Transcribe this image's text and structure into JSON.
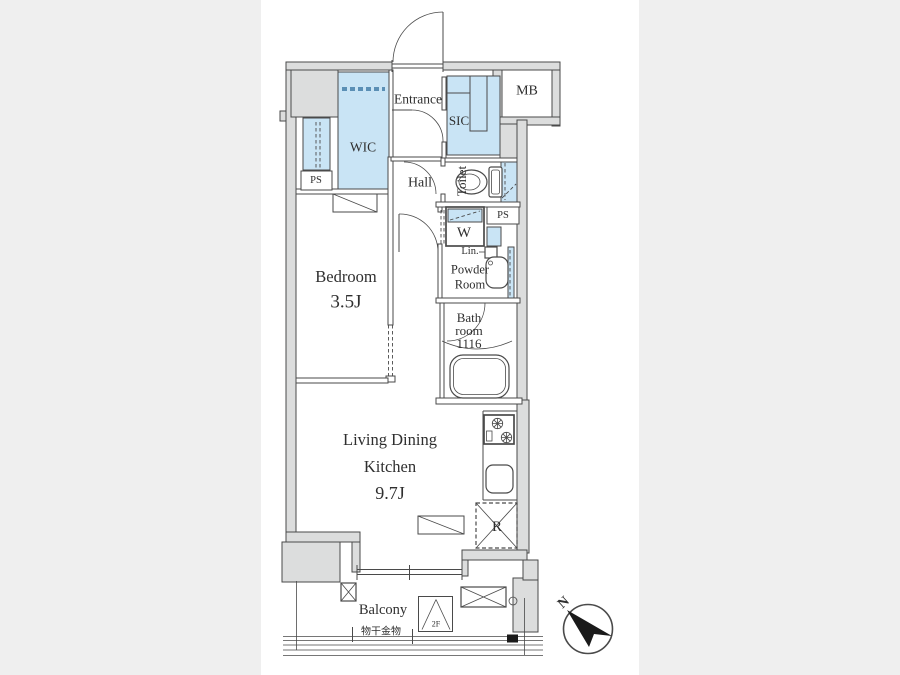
{
  "theme": {
    "bg": "#efefef",
    "canvas": "#ffffff",
    "wall_fill": "#dcdddd",
    "line": "#4a4a4a",
    "closet_blue": "#c9e4f5",
    "hanger_blue": "#5b8fb5",
    "text": "#2f2f2f",
    "ink": "#1a1a1a"
  },
  "labels": {
    "entrance": "Entrance",
    "wic": "WIC",
    "sic": "SIC",
    "mb": "MB",
    "hall": "Hall",
    "toilet": "Toilet",
    "ps_top": "PS",
    "ps_mid": "PS",
    "washer": "W",
    "linen": "Lin.",
    "powder": "Powder Room",
    "bath": [
      "Bath",
      "room",
      "1116"
    ],
    "bedroom": {
      "name": "Bedroom",
      "size": "3.5J"
    },
    "ldk": [
      "Living Dining",
      "Kitchen",
      "9.7J"
    ],
    "fridge": "R",
    "balcony": "Balcony",
    "laundry": "物干金物",
    "floor": "2F",
    "north": "N"
  }
}
